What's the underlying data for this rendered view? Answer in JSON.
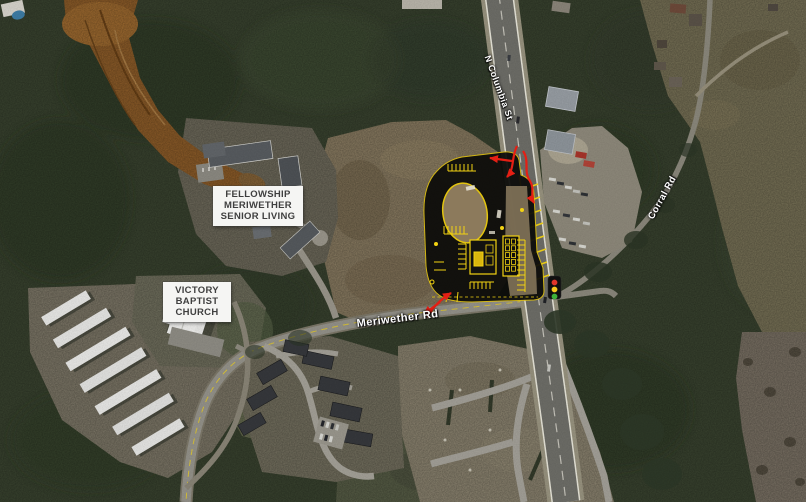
{
  "map": {
    "type": "satellite-aerial-with-site-plan",
    "place_labels": [
      {
        "id": "fellowship-meriwether-senior-living",
        "text": "FELLOWSHIP\nMERIWETHER\nSENIOR LIVING"
      },
      {
        "id": "victory-baptist-church",
        "text": "VICTORY\nBAPTIST\nCHURCH"
      }
    ],
    "road_labels": [
      {
        "id": "n-columbia-st",
        "text": "N Columbia St"
      },
      {
        "id": "meriwether-rd",
        "text": "Meriwether Rd"
      },
      {
        "id": "corral-rd",
        "text": "Corral Rd"
      }
    ],
    "overlays": {
      "site_plan": {
        "description": "proposed development site plan at NW corner of N Columbia St and Meriwether Rd",
        "line_color": "#f2d212",
        "pavement_color": "#0b0b09"
      },
      "access_arrows_color": "#e51f14",
      "traffic_signal": {
        "name": "traffic-signal-icon",
        "lens_colors": [
          "#e0362a",
          "#f4c81d",
          "#3fb13a"
        ]
      }
    }
  }
}
